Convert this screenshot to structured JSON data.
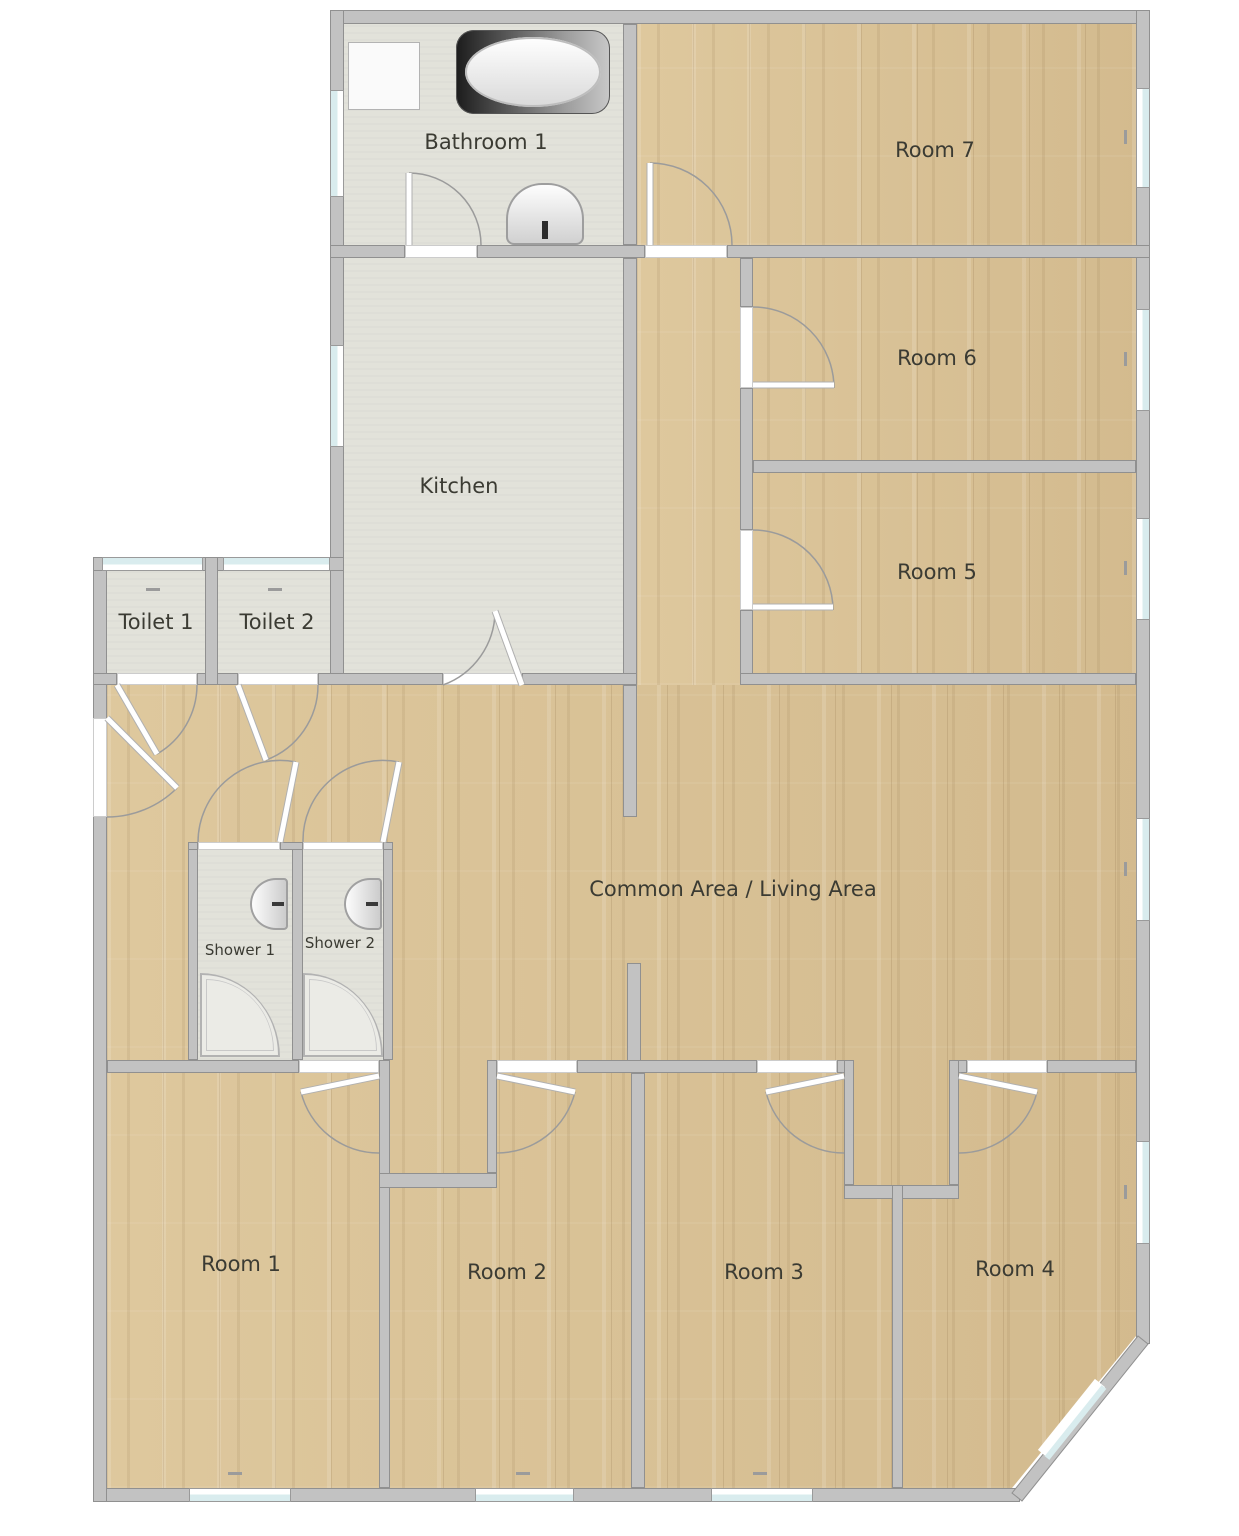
{
  "title": "Shared house floor plan",
  "rooms": [
    {
      "id": "bathroom-1",
      "label": "Bathroom 1",
      "floor": "tile"
    },
    {
      "id": "room-7",
      "label": "Room 7",
      "floor": "wood"
    },
    {
      "id": "kitchen",
      "label": "Kitchen",
      "floor": "tile"
    },
    {
      "id": "room-6",
      "label": "Room 6",
      "floor": "wood"
    },
    {
      "id": "room-5",
      "label": "Room 5",
      "floor": "wood"
    },
    {
      "id": "toilet-1",
      "label": "Toilet 1",
      "floor": "tile"
    },
    {
      "id": "toilet-2",
      "label": "Toilet 2",
      "floor": "tile"
    },
    {
      "id": "common-area",
      "label": "Common Area / Living Area",
      "floor": "wood"
    },
    {
      "id": "shower-1",
      "label": "Shower 1",
      "floor": "tile"
    },
    {
      "id": "shower-2",
      "label": "Shower 2",
      "floor": "tile"
    },
    {
      "id": "room-1",
      "label": "Room 1",
      "floor": "wood"
    },
    {
      "id": "room-2",
      "label": "Room 2",
      "floor": "wood"
    },
    {
      "id": "room-3",
      "label": "Room 3",
      "floor": "wood"
    },
    {
      "id": "room-4",
      "label": "Room 4",
      "floor": "wood"
    }
  ],
  "fixtures": [
    "bathtub-icon",
    "shower-cubicle-icon",
    "bathroom-sink-icon",
    "shower-sink-icon",
    "shower-sink-icon",
    "shower-tray-icon",
    "shower-tray-icon"
  ],
  "colors": {
    "wall": "#c2c2c2",
    "wall_border": "#909090",
    "wood_floor": "#d7c094",
    "tile_floor": "#e2e2da",
    "window_glass": "#d9ecee",
    "door_arc": "#9b9b9b",
    "label_text": "#3b3b33",
    "background": "#ffffff"
  }
}
